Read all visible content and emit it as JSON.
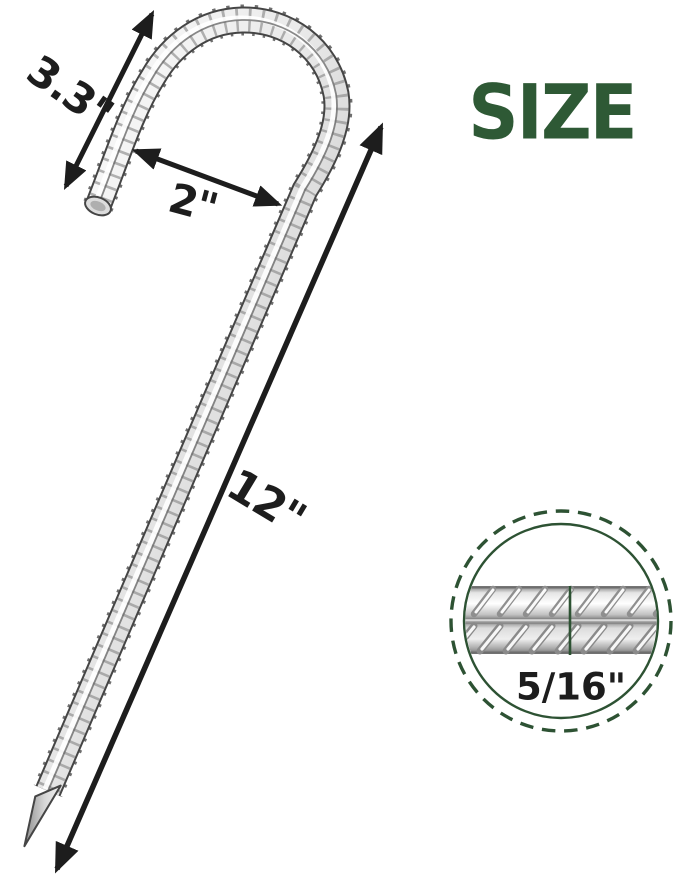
{
  "title": "SIZE",
  "dimensions": {
    "hook_height": "3.3\"",
    "hook_opening": "2\"",
    "total_length": "12\"",
    "diameter": "5/16\""
  },
  "colors": {
    "accent_green": "#2E5935",
    "detail_circle_green": "#2D5233",
    "dimension_ink": "#1d1d1d",
    "metal_light": "#ffffff",
    "metal_mid": "#d9d9d9",
    "metal_dark": "#b0b0b0",
    "outline_gray": "#454545"
  }
}
